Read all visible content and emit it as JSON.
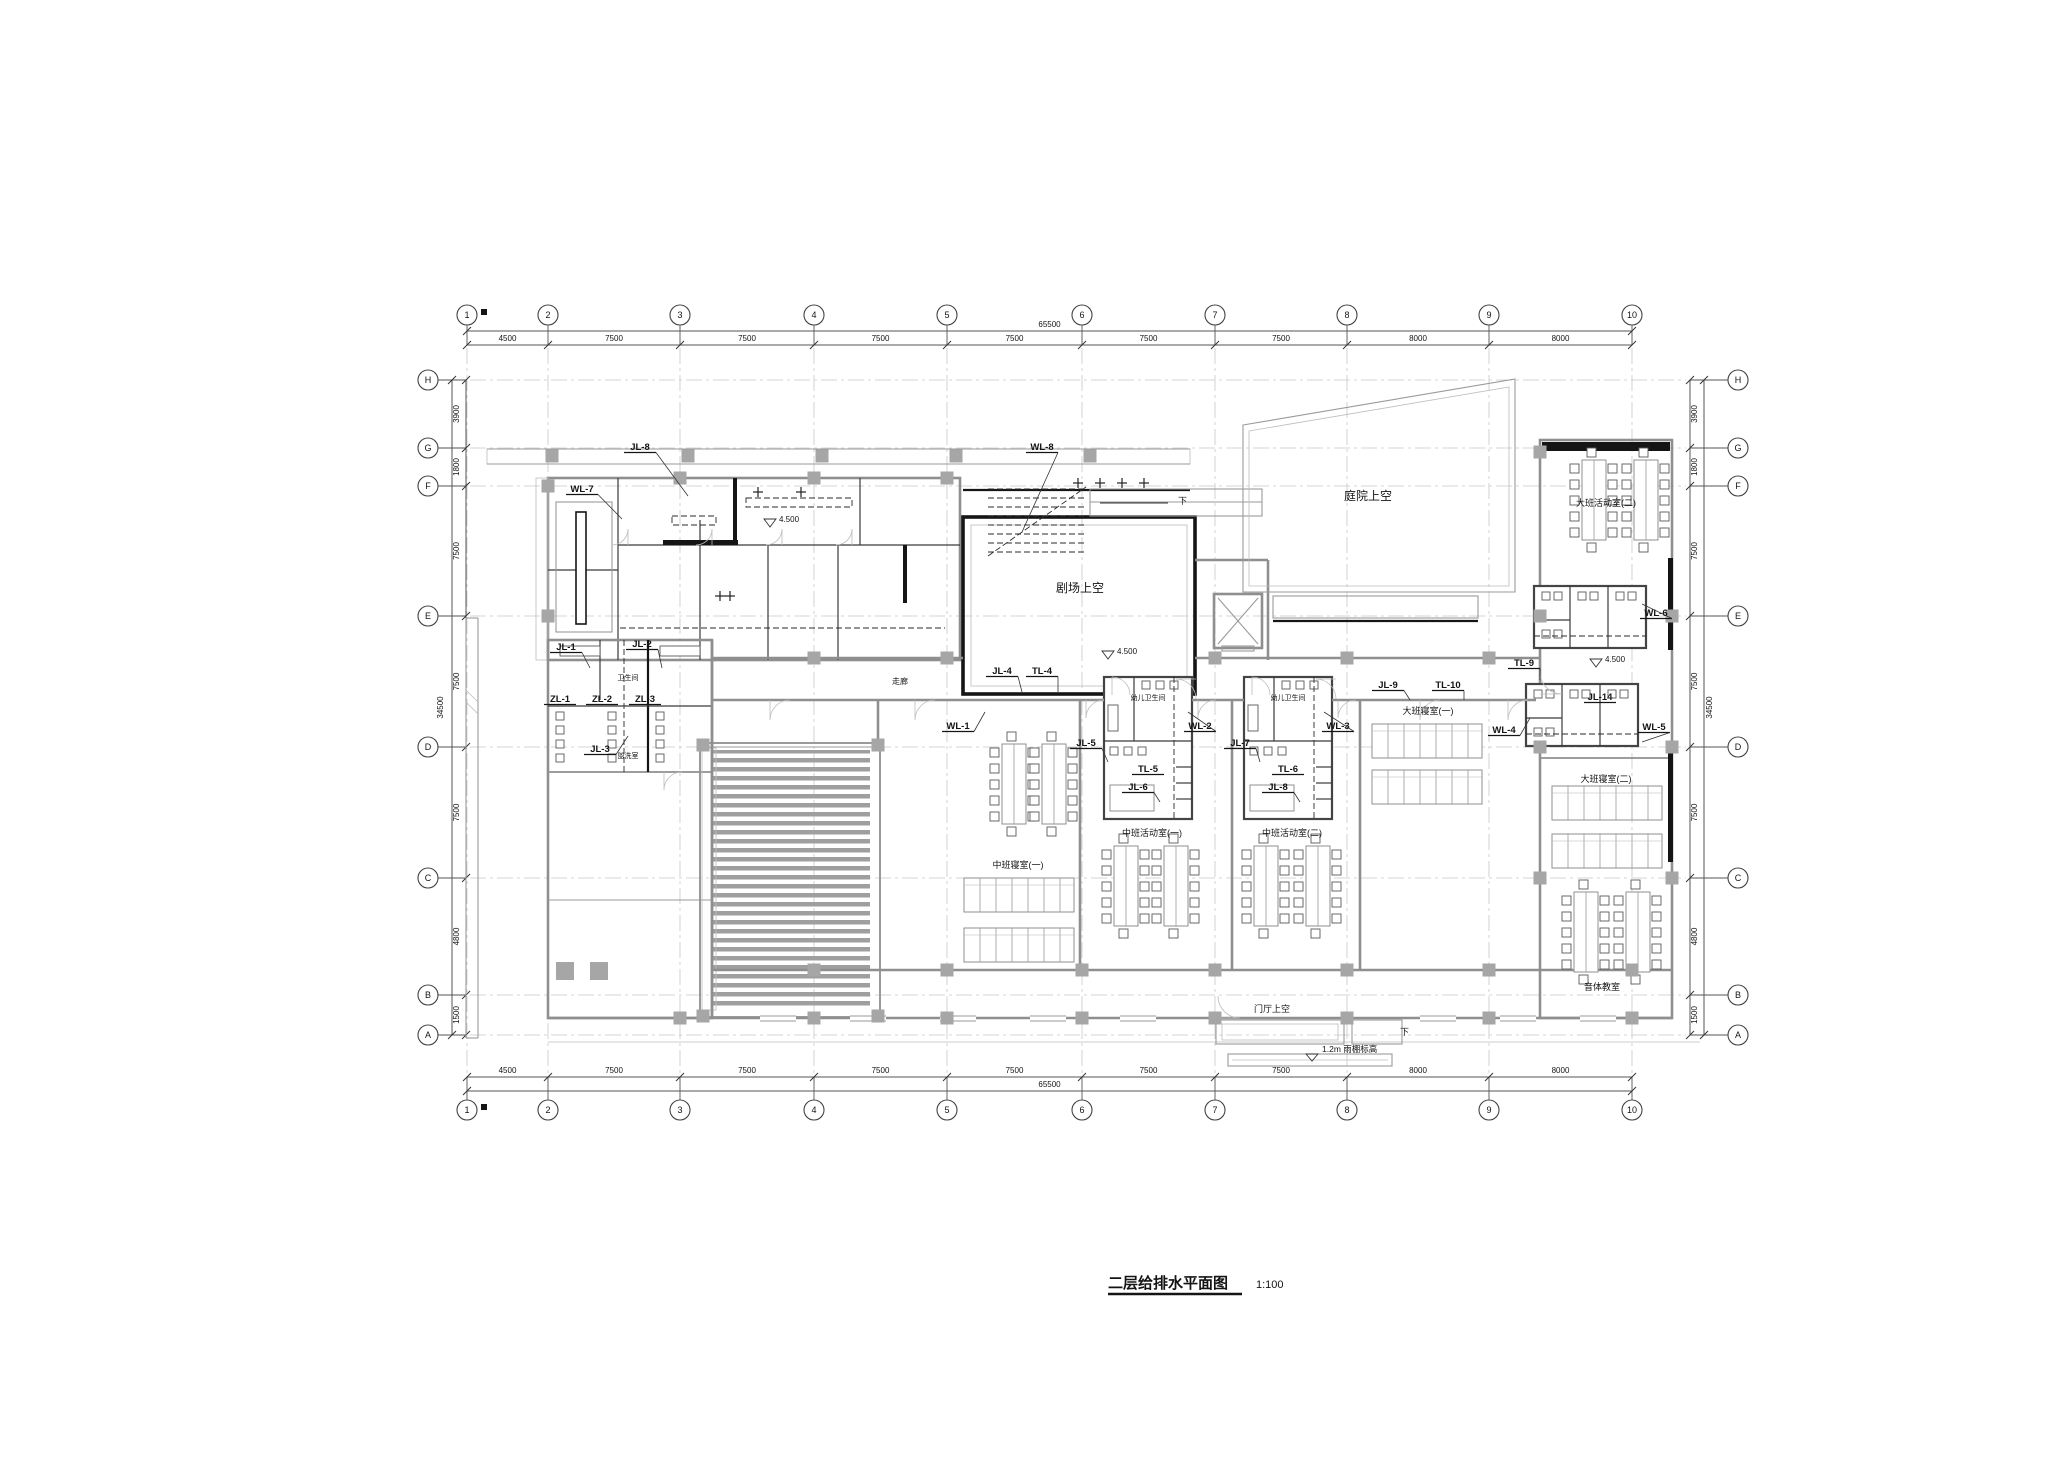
{
  "title": {
    "text": "二层给排水平面图",
    "scale": "1:100"
  },
  "colors": {
    "wall": "#8f8f8f",
    "bold": "#151515",
    "gridline": "#c8c8c8",
    "column": "#a6a6a6"
  },
  "grid": {
    "top": {
      "labels": [
        "1",
        "2",
        "3",
        "4",
        "5",
        "6",
        "7",
        "8",
        "9",
        "10"
      ],
      "x": [
        467,
        548,
        680,
        814,
        947,
        1082,
        1215,
        1347,
        1489,
        1632
      ],
      "dims": [
        "4500",
        "7500",
        "7500",
        "7500",
        "7500",
        "7500",
        "7500",
        "8000",
        "8000"
      ],
      "overall": "65500"
    },
    "bottom": {
      "labels": [
        "1",
        "2",
        "3",
        "4",
        "5",
        "6",
        "7",
        "8",
        "9",
        "10"
      ],
      "x": [
        467,
        548,
        680,
        814,
        947,
        1082,
        1215,
        1347,
        1489,
        1632
      ],
      "dims": [
        "4500",
        "7500",
        "7500",
        "7500",
        "7500",
        "7500",
        "7500",
        "8000",
        "8000"
      ],
      "overall": "65500"
    },
    "left": {
      "labels": [
        "H",
        "G",
        "F",
        "E",
        "D",
        "C",
        "B",
        "A"
      ],
      "y": [
        380,
        448,
        486,
        616,
        747,
        878,
        995,
        1035
      ],
      "dims": [
        "3900",
        "1800",
        "7500",
        "7500",
        "7500",
        "4800",
        "1500"
      ],
      "overall": "34500"
    },
    "right": {
      "labels": [
        "H",
        "G",
        "F",
        "E",
        "D",
        "C",
        "B",
        "A"
      ],
      "y": [
        380,
        448,
        486,
        616,
        747,
        878,
        995,
        1035
      ],
      "dims": [
        "3900",
        "1800",
        "7500",
        "7500",
        "7500",
        "4800",
        "1500"
      ],
      "overall": "34500"
    }
  },
  "plan": {
    "riser_labels": [
      {
        "t": "JL-8",
        "x": 640,
        "y": 450,
        "lx": 688,
        "ly": 496
      },
      {
        "t": "WL-8",
        "x": 1042,
        "y": 450,
        "lx": 1022,
        "ly": 532
      },
      {
        "t": "WL-7",
        "x": 582,
        "y": 492,
        "lx": 622,
        "ly": 519
      },
      {
        "t": "JL-1",
        "x": 566,
        "y": 650,
        "lx": 590,
        "ly": 668
      },
      {
        "t": "JL-2",
        "x": 642,
        "y": 647,
        "lx": 662,
        "ly": 668
      },
      {
        "t": "ZL-1",
        "x": 560,
        "y": 702
      },
      {
        "t": "ZL-2",
        "x": 602,
        "y": 702
      },
      {
        "t": "ZL-3",
        "x": 645,
        "y": 702
      },
      {
        "t": "JL-3",
        "x": 600,
        "y": 752,
        "lx": 628,
        "ly": 736
      },
      {
        "t": "JL-4",
        "x": 1002,
        "y": 674,
        "lx": 1022,
        "ly": 692
      },
      {
        "t": "TL-4",
        "x": 1042,
        "y": 674,
        "lx": 1058,
        "ly": 692
      },
      {
        "t": "WL-1",
        "x": 958,
        "y": 729,
        "lx": 985,
        "ly": 712
      },
      {
        "t": "JL-5",
        "x": 1086,
        "y": 746,
        "lx": 1108,
        "ly": 762
      },
      {
        "t": "WL-2",
        "x": 1200,
        "y": 729,
        "lx": 1188,
        "ly": 712
      },
      {
        "t": "TL-5",
        "x": 1148,
        "y": 772
      },
      {
        "t": "JL-6",
        "x": 1138,
        "y": 790,
        "lx": 1160,
        "ly": 802
      },
      {
        "t": "JL-7",
        "x": 1240,
        "y": 746,
        "lx": 1260,
        "ly": 762
      },
      {
        "t": "WL-3",
        "x": 1338,
        "y": 729,
        "lx": 1324,
        "ly": 712
      },
      {
        "t": "TL-6",
        "x": 1288,
        "y": 772
      },
      {
        "t": "JL-8",
        "x": 1278,
        "y": 790,
        "lx": 1300,
        "ly": 802
      },
      {
        "t": "JL-9",
        "x": 1388,
        "y": 688,
        "lx": 1410,
        "ly": 700
      },
      {
        "t": "TL-10",
        "x": 1448,
        "y": 688,
        "lx": 1464,
        "ly": 700
      },
      {
        "t": "TL-9",
        "x": 1524,
        "y": 666,
        "lx": 1540,
        "ly": 680
      },
      {
        "t": "WL-4",
        "x": 1504,
        "y": 733,
        "lx": 1530,
        "ly": 718
      },
      {
        "t": "WL-6",
        "x": 1656,
        "y": 616,
        "lx": 1642,
        "ly": 604
      },
      {
        "t": "JL-14",
        "x": 1600,
        "y": 700
      },
      {
        "t": "WL-5",
        "x": 1654,
        "y": 730,
        "lx": 1642,
        "ly": 742
      }
    ],
    "room_labels": [
      {
        "t": "剧场上空",
        "x": 1080,
        "y": 592,
        "s": 12
      },
      {
        "t": "庭院上空",
        "x": 1368,
        "y": 500,
        "s": 12
      },
      {
        "t": "门厅上空",
        "x": 1272,
        "y": 1012,
        "s": 9
      },
      {
        "t": "中班寝室(一)",
        "x": 1018,
        "y": 868,
        "s": 9
      },
      {
        "t": "中班活动室(一)",
        "x": 1152,
        "y": 836,
        "s": 9
      },
      {
        "t": "中班活动室(二)",
        "x": 1292,
        "y": 836,
        "s": 9
      },
      {
        "t": "大班寝室(一)",
        "x": 1428,
        "y": 714,
        "s": 9
      },
      {
        "t": "大班活动室(二)",
        "x": 1606,
        "y": 506,
        "s": 9
      },
      {
        "t": "大班寝室(二)",
        "x": 1606,
        "y": 782,
        "s": 9
      },
      {
        "t": "音体教室",
        "x": 1602,
        "y": 990,
        "s": 9
      },
      {
        "t": "幼儿卫生间",
        "x": 1148,
        "y": 700,
        "s": 7
      },
      {
        "t": "幼儿卫生间",
        "x": 1288,
        "y": 700,
        "s": 7
      },
      {
        "t": "卫生间",
        "x": 628,
        "y": 680,
        "s": 7
      },
      {
        "t": "盥洗室",
        "x": 628,
        "y": 758,
        "s": 7
      },
      {
        "t": "走廊",
        "x": 900,
        "y": 684,
        "s": 8
      }
    ],
    "elev_marks": [
      {
        "t": "4.500",
        "x": 1108,
        "y": 656
      },
      {
        "t": "4.500",
        "x": 1596,
        "y": 664
      },
      {
        "t": "4.500",
        "x": 770,
        "y": 524
      }
    ],
    "canopy_note": {
      "t": "1.2m 雨棚标高",
      "x": 1322,
      "y": 1052
    },
    "stair_notes": [
      {
        "t": "下",
        "x": 1178,
        "y": 504
      },
      {
        "t": "下",
        "x": 1400,
        "y": 1035
      }
    ]
  }
}
